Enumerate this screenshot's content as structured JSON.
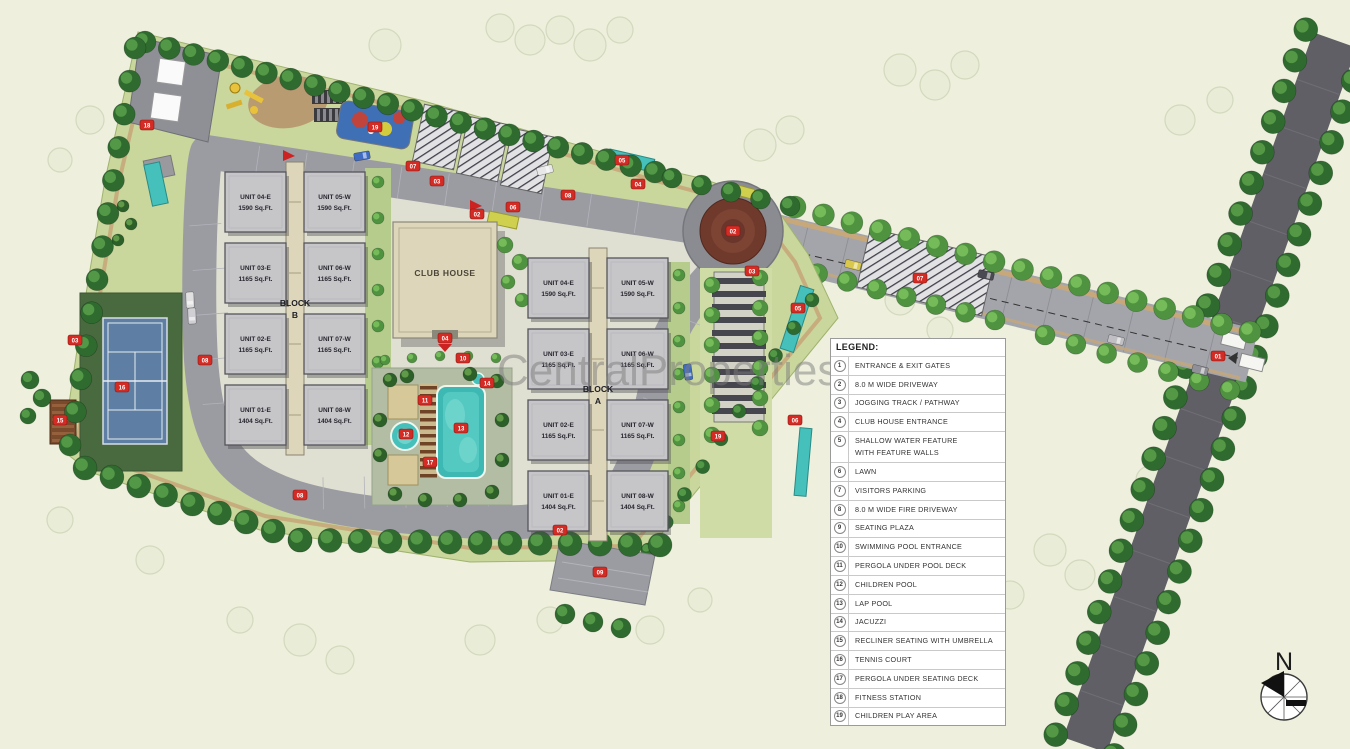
{
  "watermark": "CentralProperties",
  "compass": {
    "north_label": "N"
  },
  "club_house": {
    "label": "CLUB HOUSE"
  },
  "blocks": [
    {
      "label_line1": "BLOCK",
      "label_line2": "B",
      "units": [
        {
          "name": "UNIT 04-E",
          "area": "1590 Sq.Ft."
        },
        {
          "name": "UNIT 05-W",
          "area": "1590 Sq.Ft."
        },
        {
          "name": "UNIT 03-E",
          "area": "1165 Sq.Ft."
        },
        {
          "name": "UNIT 06-W",
          "area": "1165 Sq.Ft."
        },
        {
          "name": "UNIT 02-E",
          "area": "1165 Sq.Ft."
        },
        {
          "name": "UNIT 07-W",
          "area": "1165 Sq.Ft."
        },
        {
          "name": "UNIT 01-E",
          "area": "1404 Sq.Ft."
        },
        {
          "name": "UNIT 08-W",
          "area": "1404 Sq.Ft."
        }
      ]
    },
    {
      "label_line1": "BLOCK",
      "label_line2": "A",
      "units": [
        {
          "name": "UNIT 04-E",
          "area": "1590 Sq.Ft."
        },
        {
          "name": "UNIT 05-W",
          "area": "1590 Sq.Ft."
        },
        {
          "name": "UNIT 03-E",
          "area": "1165 Sq.Ft."
        },
        {
          "name": "UNIT 06-W",
          "area": "1165 Sq.Ft."
        },
        {
          "name": "UNIT 02-E",
          "area": "1165 Sq.Ft."
        },
        {
          "name": "UNIT 07-W",
          "area": "1165 Sq.Ft."
        },
        {
          "name": "UNIT 01-E",
          "area": "1404 Sq.Ft."
        },
        {
          "name": "UNIT 08-W",
          "area": "1404 Sq.Ft."
        }
      ]
    }
  ],
  "legend": {
    "title": "LEGEND:",
    "items": [
      {
        "num": "1",
        "label": "ENTRANCE & EXIT GATES"
      },
      {
        "num": "2",
        "label": "8.0 M WIDE DRIVEWAY"
      },
      {
        "num": "3",
        "label": "JOGGING TRACK / PATHWAY"
      },
      {
        "num": "4",
        "label": "CLUB HOUSE ENTRANCE"
      },
      {
        "num": "5",
        "label": "SHALLOW WATER FEATURE",
        "label2": "WITH FEATURE WALLS"
      },
      {
        "num": "6",
        "label": "LAWN"
      },
      {
        "num": "7",
        "label": "VISITORS PARKING"
      },
      {
        "num": "8",
        "label": "8.0 M WIDE FIRE DRIVEWAY"
      },
      {
        "num": "9",
        "label": "SEATING PLAZA"
      },
      {
        "num": "10",
        "label": "SWIMMING POOL ENTRANCE"
      },
      {
        "num": "11",
        "label": "PERGOLA UNDER POOL DECK"
      },
      {
        "num": "12",
        "label": "CHILDREN POOL"
      },
      {
        "num": "13",
        "label": "LAP POOL"
      },
      {
        "num": "14",
        "label": "JACUZZI"
      },
      {
        "num": "15",
        "label": "RECLINER SEATING WITH UMBRELLA"
      },
      {
        "num": "16",
        "label": "TENNIS COURT"
      },
      {
        "num": "17",
        "label": "PERGOLA UNDER SEATING DECK"
      },
      {
        "num": "18",
        "label": "FITNESS STATION"
      },
      {
        "num": "19",
        "label": "CHILDREN PLAY AREA"
      }
    ]
  },
  "markers": [
    {
      "num": "07",
      "x": 413,
      "y": 166
    },
    {
      "num": "03",
      "x": 437,
      "y": 181
    },
    {
      "num": "04",
      "x": 638,
      "y": 184
    },
    {
      "num": "08",
      "x": 568,
      "y": 195
    },
    {
      "num": "06",
      "x": 513,
      "y": 207
    },
    {
      "num": "02",
      "x": 477,
      "y": 214
    },
    {
      "num": "05",
      "x": 622,
      "y": 160
    },
    {
      "num": "02",
      "x": 733,
      "y": 231
    },
    {
      "num": "01",
      "x": 1218,
      "y": 356
    },
    {
      "num": "03",
      "x": 752,
      "y": 271
    },
    {
      "num": "05",
      "x": 798,
      "y": 308
    },
    {
      "num": "07",
      "x": 920,
      "y": 278
    },
    {
      "num": "06",
      "x": 795,
      "y": 420
    },
    {
      "num": "19",
      "x": 718,
      "y": 436
    },
    {
      "num": "08",
      "x": 205,
      "y": 360
    },
    {
      "num": "03",
      "x": 75,
      "y": 340
    },
    {
      "num": "16",
      "x": 122,
      "y": 387
    },
    {
      "num": "15",
      "x": 60,
      "y": 420
    },
    {
      "num": "18",
      "x": 147,
      "y": 125
    },
    {
      "num": "19",
      "x": 375,
      "y": 127
    },
    {
      "num": "04",
      "x": 445,
      "y": 338
    },
    {
      "num": "10",
      "x": 463,
      "y": 358
    },
    {
      "num": "11",
      "x": 425,
      "y": 400
    },
    {
      "num": "12",
      "x": 406,
      "y": 434
    },
    {
      "num": "13",
      "x": 461,
      "y": 428
    },
    {
      "num": "14",
      "x": 487,
      "y": 383
    },
    {
      "num": "17",
      "x": 430,
      "y": 462
    },
    {
      "num": "09",
      "x": 600,
      "y": 572
    },
    {
      "num": "08",
      "x": 300,
      "y": 495
    },
    {
      "num": "02",
      "x": 560,
      "y": 530
    }
  ],
  "colors": {
    "background": "#eef0dd",
    "site_lawn": "#c9d69c",
    "campus_paving": "#e0e0d2",
    "road": "#9b9ca2",
    "boulevard": "#5f5f65",
    "building": "#c6c6c9",
    "beige": "#ddd6ba",
    "tree_dark": "#2f6b2f",
    "tree_mid": "#4f9340",
    "tree_light": "#7cc25e",
    "pool": "#45c0ba",
    "tennis_court": "#5e7fa3",
    "tennis_pad": "#49693f",
    "roundabout": "#6f3a2c",
    "marker_red": "#d42b24",
    "path_tan": "#c7a87a"
  }
}
